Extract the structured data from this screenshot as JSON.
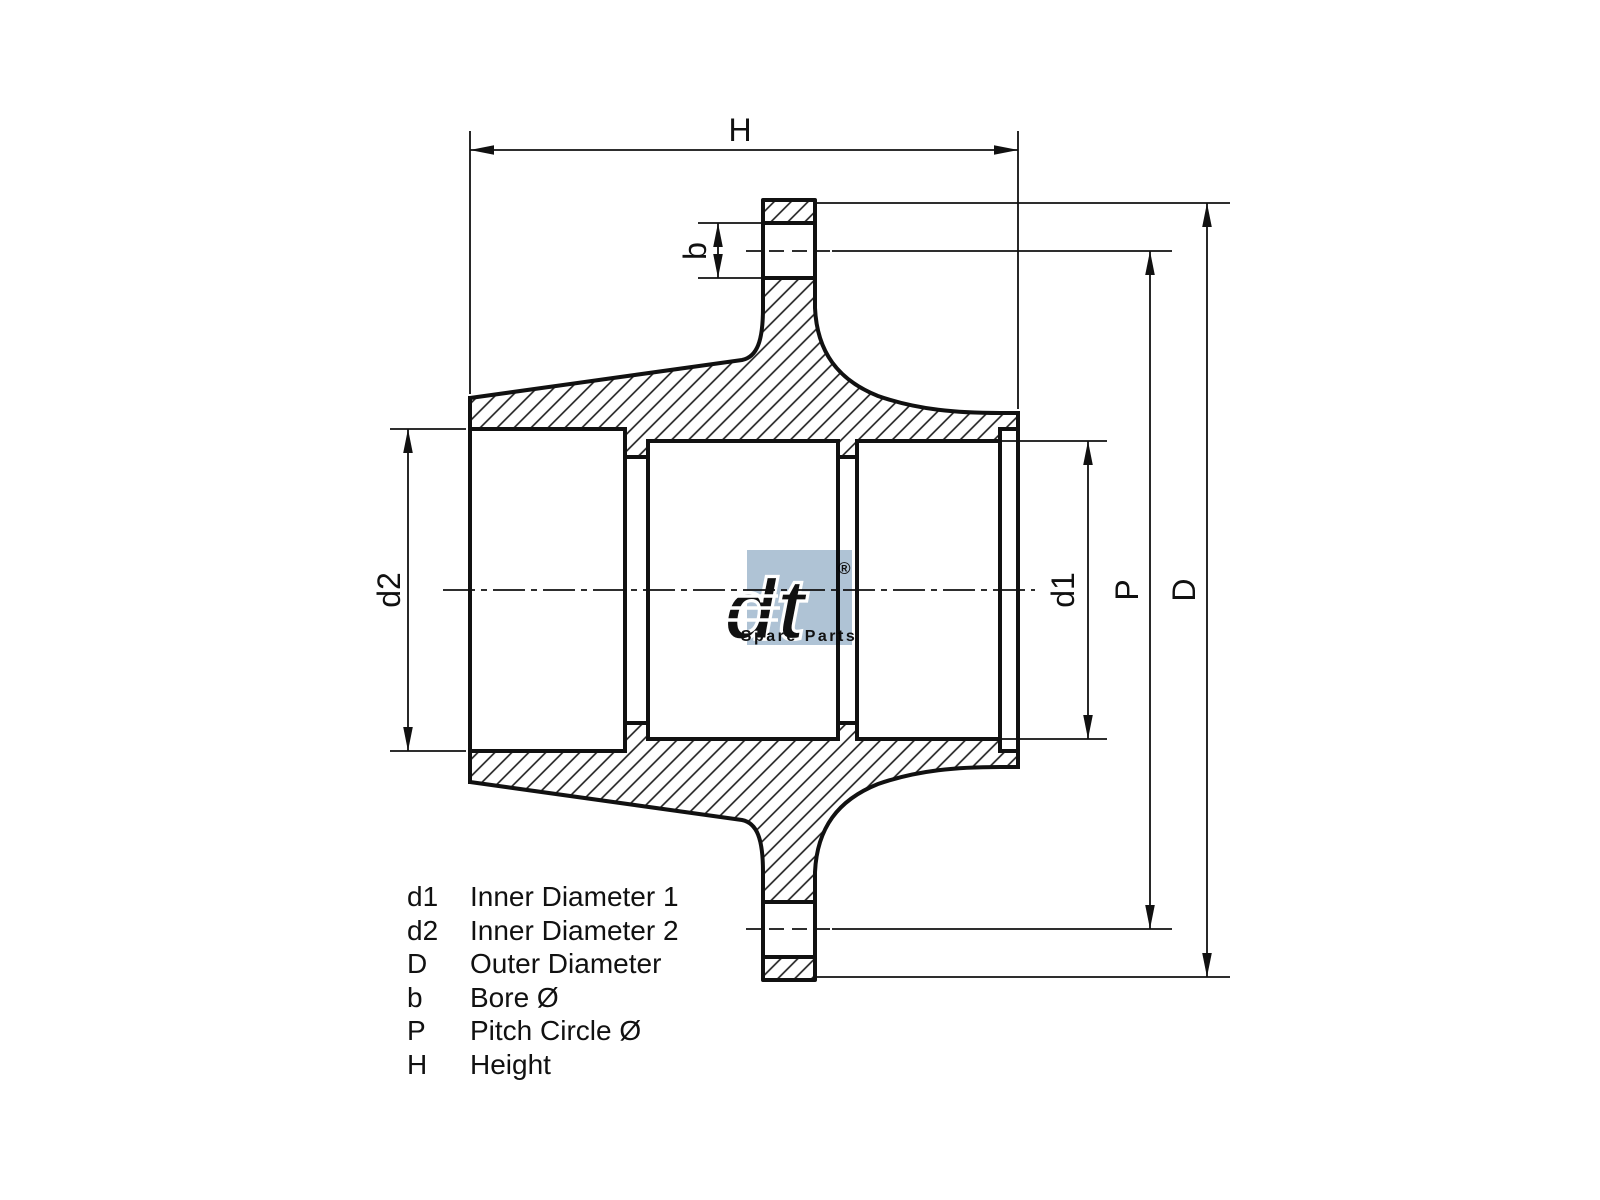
{
  "page": {
    "background_color": "#ffffff",
    "line_color": "#111111"
  },
  "drawing": {
    "type": "technical-section-drawing",
    "subject": "wheel hub cross section",
    "dimensions": {
      "height_label": "H",
      "bore_label": "b",
      "inner_diameter_2_label": "d2",
      "inner_diameter_1_label": "d1",
      "pitch_circle_label": "P",
      "outer_diameter_label": "D"
    },
    "legend": {
      "rows": [
        {
          "symbol": "d1",
          "description": "Inner Diameter 1"
        },
        {
          "symbol": "d2",
          "description": "Inner Diameter 2"
        },
        {
          "symbol": "D",
          "description": "Outer Diameter"
        },
        {
          "symbol": "b",
          "description": "Bore Ø"
        },
        {
          "symbol": "P",
          "description": "Pitch Circle Ø"
        },
        {
          "symbol": "H",
          "description": "Height"
        }
      ]
    },
    "watermark": {
      "brand": "dt",
      "registered_mark": "®",
      "subtitle": "Spare Parts",
      "color": "#afc3d5"
    }
  }
}
